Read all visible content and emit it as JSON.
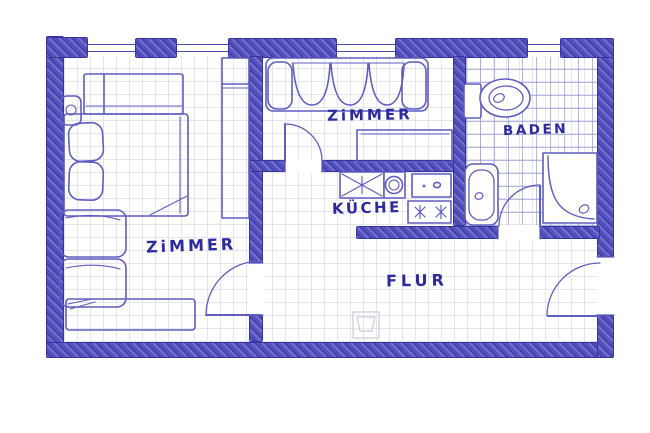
{
  "title": "Hand-drawn apartment floor plan sketch (blue ink)",
  "rooms": {
    "bedroom": {
      "label": "ZiMMER"
    },
    "living": {
      "label": "ZiMMER"
    },
    "kitchen": {
      "label": "KÜCHE"
    },
    "bathroom": {
      "label": "BADEN"
    },
    "hallway": {
      "label": "FLUR"
    }
  },
  "colors": {
    "wall_blue": "#5451be",
    "ink_blue": "#5f5dc0",
    "label_blue": "#2c2a9e",
    "tile_blue": "#8d90cf",
    "grid_gray": "#e4e5f0",
    "pencil_gray": "#c6c6cf",
    "paper_white": "#ffffff"
  },
  "elements": {
    "windows_top_wall_count": 4,
    "doors": [
      "bedroom-door",
      "living-room-door",
      "bathroom-door",
      "entrance-door"
    ],
    "bedroom_furniture": [
      "double-bed",
      "pillows",
      "wardrobe",
      "nightstand",
      "cabinet",
      "cabinet",
      "dresser",
      "tall-closet"
    ],
    "living_furniture": [
      "sofa",
      "sideboard-table"
    ],
    "kitchen_fixtures": [
      "sink-counter",
      "round-basin",
      "counter",
      "stove-two-burners"
    ],
    "bathroom_fixtures": [
      "toilet",
      "bathtub",
      "shower"
    ],
    "hallway_marks": [
      "faint-pencil-square"
    ]
  }
}
